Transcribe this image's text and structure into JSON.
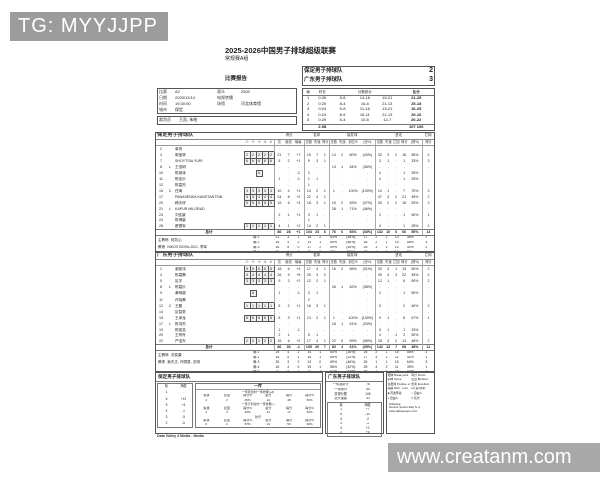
{
  "watermarks": {
    "telegram": "TG: MYYJJPP",
    "site": "www.creatanm.com"
  },
  "doc": {
    "title": "2025-2026中国男子排球超级联赛",
    "subtitle": "常规赛A组",
    "report_label": "比赛报告",
    "footer": "Data Volley 4 Media - Media"
  },
  "scoreboard": {
    "rows": [
      [
        "保定男子排球队",
        "2"
      ],
      [
        "广东男子排球队",
        "3"
      ]
    ]
  },
  "match_info": {
    "rows": [
      [
        "比赛",
        "A2",
        "观众",
        "2500"
      ],
      [
        "日期",
        "2025/12/14",
        "电视转播",
        ""
      ],
      [
        "时间",
        "19:30:00",
        "场馆",
        "河北体育馆"
      ],
      [
        "城市",
        "保定",
        "",
        ""
      ]
    ],
    "referee_row": [
      [
        "裁判员",
        "王凯, 朱皓"
      ]
    ]
  },
  "set_table": {
    "headers": {
      "set": "局",
      "duration": "时长",
      "partials": "分数统计",
      "score": "比分"
    },
    "rows": [
      [
        "1",
        "0:26",
        "5-8",
        "14-16",
        "19-21",
        "21-25"
      ],
      [
        "2",
        "0:25",
        "8-4",
        "16-8",
        "21-13",
        "25-18"
      ],
      [
        "3",
        "0:24",
        "6-8",
        "11-16",
        "13-21",
        "16-25"
      ],
      [
        "4",
        "0:24",
        "8-5",
        "16-11",
        "21-13",
        "25-16"
      ],
      [
        "5",
        "0:29",
        "5-4",
        "10-6",
        "12-7",
        "20-22"
      ]
    ],
    "total_row": [
      [
        "",
        "2:08",
        "",
        "",
        "",
        "107 106"
      ]
    ]
  },
  "team_a": {
    "name": "保定男子排球队",
    "header": {
      "groups": [
        "得分",
        "发球",
        "接发球",
        "进攻",
        "拦网"
      ]
    },
    "header_row": [
      [
        "",
        "",
        "",
        "①",
        "②",
        "③",
        "④",
        "⑤",
        "总",
        "破攻",
        "输赢",
        "总数",
        "失误",
        "得分",
        "总数",
        "失误",
        "到位%",
        "(优%)",
        "总数",
        "失误",
        "拦回",
        "得分",
        "(得%)",
        "得分"
      ]
    ],
    "players": [
      [
        "2",
        "",
        "单亮",
        "",
        "",
        "",
        "",
        "",
        ".",
        ".",
        ".",
        ".",
        ".",
        ".",
        ".",
        ".",
        ".",
        ".",
        ".",
        ".",
        ".",
        ".",
        ".",
        "."
      ],
      [
        "4",
        "",
        "郭宝林",
        "[2]",
        "[2]",
        "[2]",
        "[2]",
        "[2]",
        "21",
        "7",
        "+7",
        "19",
        "7",
        "1",
        "14",
        "2",
        "60%",
        "(43%)",
        "32",
        "3",
        "2",
        "18",
        "56%",
        "2"
      ],
      [
        "7",
        "",
        "SHOYTSIA YURI",
        "[6]",
        "[6]",
        "[6]",
        "[6]",
        "[6]",
        "5",
        "2",
        "+1",
        "9",
        "3",
        "1",
        ".",
        ".",
        ".",
        ".",
        "3",
        "1",
        ".",
        "1",
        "33%",
        "3"
      ],
      [
        "8",
        "L",
        "王浩明",
        "",
        "",
        "",
        "",
        "",
        ".",
        ".",
        ".",
        ".",
        ".",
        ".",
        "14",
        "1",
        "64%",
        "(36%)",
        ".",
        ".",
        ".",
        ".",
        ".",
        "."
      ],
      [
        "10",
        "",
        "陈润泽",
        "",
        "",
        "[6]",
        "",
        "",
        ".",
        ".",
        "-2",
        "2",
        ".",
        ".",
        ".",
        ".",
        ".",
        ".",
        "4",
        ".",
        ".",
        "1",
        "25%",
        "."
      ],
      [
        "11",
        "",
        "陈佳乐",
        "",
        "",
        "",
        "",
        "",
        "1",
        ".",
        "-1",
        "1",
        "1",
        ".",
        ".",
        ".",
        ".",
        ".",
        "4",
        ".",
        ".",
        "1",
        "25%",
        "."
      ],
      [
        "12",
        "",
        "陈嘉杰",
        "",
        "",
        "",
        "",
        "",
        ".",
        ".",
        ".",
        "1",
        ".",
        ".",
        ".",
        ".",
        ".",
        ".",
        ".",
        ".",
        ".",
        ".",
        ".",
        "."
      ],
      [
        "15",
        "C",
        "任琦",
        "[3]",
        "[3]",
        "[3]",
        "[3]",
        "[3]",
        "10",
        "4",
        "+1",
        "14",
        "2",
        "1",
        "1",
        ".",
        "100%",
        "(100%)",
        "10",
        "1",
        ".",
        "7",
        "70%",
        "2"
      ],
      [
        "17",
        "",
        "PANASENKA KANSTANTSIN",
        "[4]",
        "[4]",
        "[4]",
        "[4]",
        "[4]",
        "24",
        "8",
        "+2",
        "22",
        "4",
        "1",
        ".",
        ".",
        ".",
        ".",
        "47",
        "3",
        "2",
        "21",
        "45%",
        "2"
      ],
      [
        "20",
        "",
        "韩天祥",
        "[5]",
        "[5]",
        "[5]",
        "[5]",
        "[5]",
        "19",
        "6",
        "+4",
        "18",
        "3",
        "1",
        "19",
        "2",
        "63%",
        "(37%)",
        "30",
        "2",
        "2",
        "16",
        "53%",
        "2"
      ],
      [
        "21",
        "L",
        "KAPUR MILORAD",
        "",
        "",
        "",
        "",
        "",
        ".",
        ".",
        ".",
        ".",
        ".",
        ".",
        "28",
        "1",
        "71%",
        "(46%)",
        ".",
        ".",
        ".",
        ".",
        ".",
        "."
      ],
      [
        "23",
        "",
        "刘佳豪",
        "",
        "",
        "",
        "",
        "",
        "2",
        "1",
        "+1",
        "3",
        "1",
        ".",
        ".",
        ".",
        ".",
        ".",
        "2",
        ".",
        ".",
        "1",
        "50%",
        "1"
      ],
      [
        "24",
        "",
        "陈博豪",
        "",
        "",
        "",
        "",
        "",
        ".",
        ".",
        ".",
        "1",
        ".",
        ".",
        ".",
        ".",
        ".",
        ".",
        ".",
        ".",
        ".",
        ".",
        ".",
        "."
      ],
      [
        "28",
        "",
        "翟德军",
        "[1]",
        "[1]",
        "[1]",
        "[1]",
        "[1]",
        "4",
        "1",
        "+2",
        "14",
        "2",
        "1",
        ".",
        ".",
        ".",
        ".",
        "4",
        ".",
        ".",
        "1",
        "25%",
        "2"
      ]
    ],
    "totals": [
      [
        "",
        "",
        "总计",
        "",
        "",
        "",
        "",
        "",
        "86",
        "28",
        "+1",
        "103",
        "23",
        "6",
        "76",
        "6",
        "66%",
        "(43%)",
        "132",
        "10",
        "6",
        "66",
        "50%",
        "14"
      ]
    ],
    "set_rows": [
      [
        "局 1",
        "21",
        "3",
        "1",
        "16",
        "2",
        "63%",
        "(38%)",
        "27",
        "2",
        "2",
        "13",
        "48%",
        "2"
      ],
      [
        "局 2",
        "25",
        "4",
        "2",
        "13",
        "1",
        "69%",
        "(46%)",
        "26",
        "2",
        "1",
        "15",
        "58%",
        "3"
      ],
      [
        "局 3",
        "16",
        "5",
        "0",
        "17",
        "2",
        "59%",
        "(35%)",
        "25",
        "3",
        "2",
        "10",
        "40%",
        "2"
      ],
      [
        "局 4",
        "25",
        "6",
        "2",
        "12",
        "0",
        "75%",
        "(50%)",
        "27",
        "1",
        "0",
        "16",
        "59%",
        "4"
      ],
      [
        "局 5",
        "16",
        "5",
        "1",
        "18",
        "1",
        "61%",
        "(44%)",
        "27",
        "2",
        "1",
        "12",
        "44%",
        "3"
      ]
    ],
    "coach_label": "主教练",
    "coach": "何凯心",
    "assist_label": "教练",
    "assistants": "NIKOS BOSILJCIC, 李军"
  },
  "team_b": {
    "name": "广东男子排球队",
    "header": {
      "groups": [
        "得分",
        "发球",
        "接发球",
        "进攻",
        "拦网"
      ]
    },
    "header_row": [
      [
        "",
        "",
        "",
        "①",
        "②",
        "③",
        "④",
        "⑤",
        "总",
        "破攻",
        "输赢",
        "总数",
        "失误",
        "得分",
        "总数",
        "失误",
        "到位%",
        "(优%)",
        "总数",
        "失误",
        "拦回",
        "得分",
        "(得%)",
        "得分"
      ]
    ],
    "players": [
      [
        "1",
        "",
        "谢俊鸿",
        "[5]",
        "[5]",
        "[5]",
        "[5]",
        "[5]",
        "18",
        "6",
        "+3",
        "17",
        "4",
        "1",
        "16",
        "2",
        "56%",
        "(31%)",
        "30",
        "3",
        "1",
        "15",
        "50%",
        "2"
      ],
      [
        "4",
        "",
        "陈嘉腾",
        "[4]",
        "[4]",
        "[4]",
        "[4]",
        "[4]",
        "26",
        "9",
        "+5",
        "20",
        "3",
        "2",
        ".",
        ".",
        ".",
        ".",
        "49",
        "4",
        "3",
        "22",
        "45%",
        "2"
      ],
      [
        "5",
        "",
        "区宇",
        "[3]",
        "[3]",
        "[3]",
        "[3]",
        "[3]",
        "9",
        "3",
        "+2",
        "12",
        "2",
        "1",
        ".",
        ".",
        ".",
        ".",
        "12",
        "1",
        ".",
        "6",
        "50%",
        "2"
      ],
      [
        "8",
        "L",
        "陈嘉乐",
        "",
        "",
        "",
        "",
        "",
        ".",
        ".",
        ".",
        ".",
        ".",
        ".",
        "26",
        "1",
        "62%",
        "(38%)",
        ".",
        ".",
        ".",
        ".",
        ".",
        "."
      ],
      [
        "9",
        "",
        "黄明超",
        "",
        "[6]",
        "",
        "",
        "",
        "1",
        ".",
        "-1",
        "3",
        "1",
        ".",
        ".",
        ".",
        ".",
        ".",
        "2",
        ".",
        ".",
        "1",
        "50%",
        "."
      ],
      [
        "11",
        "",
        "许晓腾",
        "",
        "",
        "",
        "",
        "",
        ".",
        ".",
        ".",
        "2",
        ".",
        ".",
        ".",
        ".",
        ".",
        ".",
        ".",
        ".",
        ".",
        ".",
        ".",
        "."
      ],
      [
        "12",
        "C",
        "王鹏",
        "[1]",
        "[1]",
        "[1]",
        "[1]",
        "[1]",
        "5",
        "2",
        "+1",
        "16",
        "3",
        "1",
        ".",
        ".",
        ".",
        ".",
        "5",
        ".",
        ".",
        "2",
        "40%",
        "2"
      ],
      [
        "14",
        "",
        "区智勇",
        "",
        "",
        "",
        "",
        "",
        ".",
        ".",
        ".",
        ".",
        ".",
        ".",
        ".",
        ".",
        ".",
        ".",
        ".",
        ".",
        ".",
        ".",
        ".",
        "."
      ],
      [
        "15",
        "",
        "王泽龙",
        "[6]",
        "[6]",
        "[6]",
        "[6]",
        "[6]",
        "8",
        "3",
        "+1",
        "13",
        "2",
        "1",
        "1",
        ".",
        "100%",
        "(100%)",
        "9",
        "1",
        ".",
        "6",
        "67%",
        "1"
      ],
      [
        "17",
        "L",
        "陈鸿杰",
        "",
        "",
        "",
        "",
        "",
        ".",
        ".",
        ".",
        ".",
        ".",
        ".",
        "18",
        "1",
        "61%",
        "(33%)",
        ".",
        ".",
        ".",
        ".",
        ".",
        "."
      ],
      [
        "19",
        "",
        "陈俊浩",
        "",
        "",
        "",
        "",
        "",
        "1",
        ".",
        "-1",
        ".",
        ".",
        ".",
        ".",
        ".",
        ".",
        ".",
        "3",
        "1",
        ".",
        "1",
        "33%",
        "."
      ],
      [
        "20",
        "",
        "王梓舟",
        "",
        "",
        "",
        "",
        "",
        "2",
        "1",
        ".",
        "5",
        "1",
        ".",
        ".",
        ".",
        ".",
        ".",
        "4",
        ".",
        "1",
        "2",
        "50%",
        "."
      ],
      [
        "22",
        "",
        "严浩东",
        "[2]",
        "[2]",
        "[2]",
        "[2]",
        "[2]",
        "16",
        "6",
        "+2",
        "17",
        "4",
        "1",
        "22",
        "0",
        "59%",
        "(36%)",
        "28",
        "3",
        "2",
        "13",
        "46%",
        "2"
      ]
    ],
    "totals": [
      [
        "",
        "",
        "总计",
        "",
        "",
        "",
        "",
        "",
        "86",
        "30",
        "-1",
        "105",
        "20",
        "7",
        "83",
        "4",
        "61%",
        "(35%)",
        "142",
        "13",
        "7",
        "68",
        "48%",
        "11"
      ]
    ],
    "set_rows": [
      [
        "局 1",
        "25",
        "4",
        "2",
        "14",
        "1",
        "64%",
        "(36%)",
        "26",
        "2",
        "1",
        "15",
        "58%",
        "3"
      ],
      [
        "局 2",
        "18",
        "5",
        "1",
        "16",
        "1",
        "56%",
        "(31%)",
        "27",
        "4",
        "2",
        "11",
        "41%",
        "1"
      ],
      [
        "局 3",
        "25",
        "3",
        "2",
        "13",
        "0",
        "69%",
        "(46%)",
        "25",
        "1",
        "1",
        "16",
        "64%",
        "3"
      ],
      [
        "局 4",
        "16",
        "4",
        "0",
        "19",
        "1",
        "58%",
        "(32%)",
        "28",
        "4",
        "2",
        "11",
        "39%",
        "1"
      ],
      [
        "局 5",
        "21",
        "4",
        "2",
        "21",
        "1",
        "57%",
        "(33%)",
        "36",
        "2",
        "1",
        "15",
        "42%",
        "3"
      ]
    ],
    "coach_label": "主教练",
    "coach": "洪俊康",
    "assist_label": "教练",
    "assistants": "吴天文, 许顺泉, 志明"
  },
  "bottom": {
    "baoding_title": "保定男子排球队",
    "guangdong_title": "广东男子排球队",
    "rotation_a": [
      [
        "轮",
        "净胜"
      ],
      [
        "1",
        "."
      ],
      [
        "6",
        "+12"
      ],
      [
        "5",
        "+4"
      ],
      [
        "4",
        "-1"
      ],
      [
        "3",
        "-5"
      ],
      [
        "2",
        "-5"
      ]
    ],
    "rotation_b": [
      [
        "轮",
        "净胜"
      ],
      [
        "1",
        "+7"
      ],
      [
        "6",
        "-10"
      ],
      [
        "5",
        "-2"
      ],
      [
        "4",
        "-1"
      ],
      [
        "3",
        "+2"
      ],
      [
        "2",
        "+5"
      ]
    ],
    "summary_b": [
      [
        "一传及防守",
        "76"
      ],
      [
        "一传得分",
        "55"
      ],
      [
        "总得分数",
        "106"
      ],
      [
        "总失误数",
        "33"
      ]
    ],
    "reception_a": {
      "title": "一传",
      "s1_label": "一传到位时一传效果(+#)",
      "s1": [
        [
          "失误",
          "拦回",
          "得分%",
          "总分",
          "得分",
          "得分%"
        ],
        [
          "2",
          "2",
          "45%",
          "14",
          "48",
          "53%"
        ]
      ],
      "s2_label": "一传不到位时一传效果(-)",
      "s2": [
        [
          "失误",
          "拦回",
          "得分%",
          "总分",
          "得分",
          "得分%"
        ],
        [
          "2",
          "3",
          "43%",
          "21",
          "17",
          "52%"
        ]
      ],
      "s3_label": "防守",
      "s3": [
        [
          "失误",
          "拦回",
          "得分%",
          "总分",
          "得分",
          "得分%"
        ],
        [
          "6",
          "2",
          "57%",
          "14",
          "50",
          "30%"
        ]
      ]
    },
    "legend": {
      "rows": [
        [
          "粗体 Break point",
          "得分 Points"
        ],
        [
          "斜体 Serve",
          "拦回 Blocked"
        ],
        [
          "接发球 Positive +#",
          "优秀 Excellent"
        ],
        [
          "输赢 Won - Lost",
          "(2) 第2替补"
        ],
        [
          "■ 首发阵容",
          "○ 自由人"
        ],
        [
          "L 自由人",
          "C 队长"
        ]
      ],
      "software": [
        "Software",
        "Genius Sports Italy S.r.l.",
        "www.dataproject.com"
      ]
    }
  }
}
